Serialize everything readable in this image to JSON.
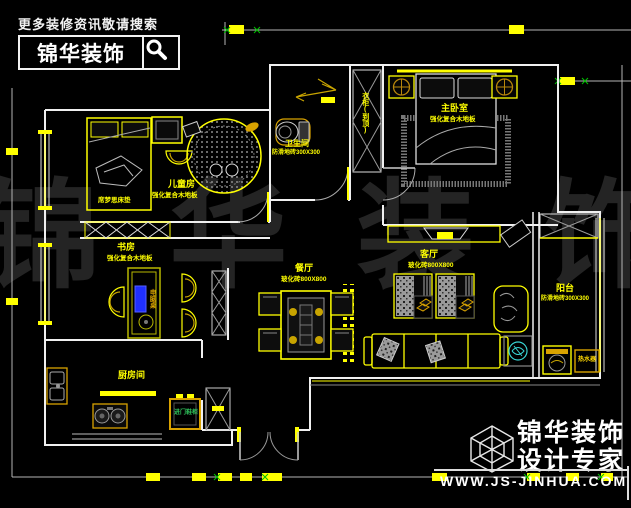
{
  "branding_top": {
    "tagline": "更多装修资讯敬请搜索",
    "brand": "锦华装饰"
  },
  "branding_bottom": {
    "brand": "锦华装饰",
    "subtitle": "设计专家",
    "url": "WWW.JS-JINHUA.COM"
  },
  "watermark": {
    "c1": "锦",
    "c2": "华",
    "c3": "装",
    "c4": "饰"
  },
  "rooms": {
    "children": {
      "name": "儿童房",
      "floor": "强化复合木地板",
      "bed_note": "席梦思床垫"
    },
    "bathroom": {
      "name": "卫生间",
      "floor": "防滑地砖300X300"
    },
    "wardrobe": {
      "label": "衣柜(到顶)"
    },
    "master": {
      "name": "主卧室",
      "floor": "强化复合木地板"
    },
    "study": {
      "name": "书房",
      "floor": "强化复合木地板",
      "desk": "电脑桌"
    },
    "dining": {
      "name": "餐厅",
      "floor": "玻化砖800X800"
    },
    "living": {
      "name": "客厅",
      "floor": "玻化砖800X800"
    },
    "kitchen": {
      "name": "厨房间"
    },
    "balcony": {
      "name": "阳台",
      "floor": "防滑地砖300X300",
      "appliance": "热水器"
    },
    "entry": {
      "cabinet": "进门鞋柜"
    }
  },
  "colors": {
    "background": "#000000",
    "furniture_yellow": "#ffff00",
    "accent_orange": "#d8a200",
    "wall_white": "#f0f0f0",
    "green_text": "#2ec05a",
    "monitor_blue": "#2030ff",
    "plant_cyan": "#39d3d3"
  }
}
